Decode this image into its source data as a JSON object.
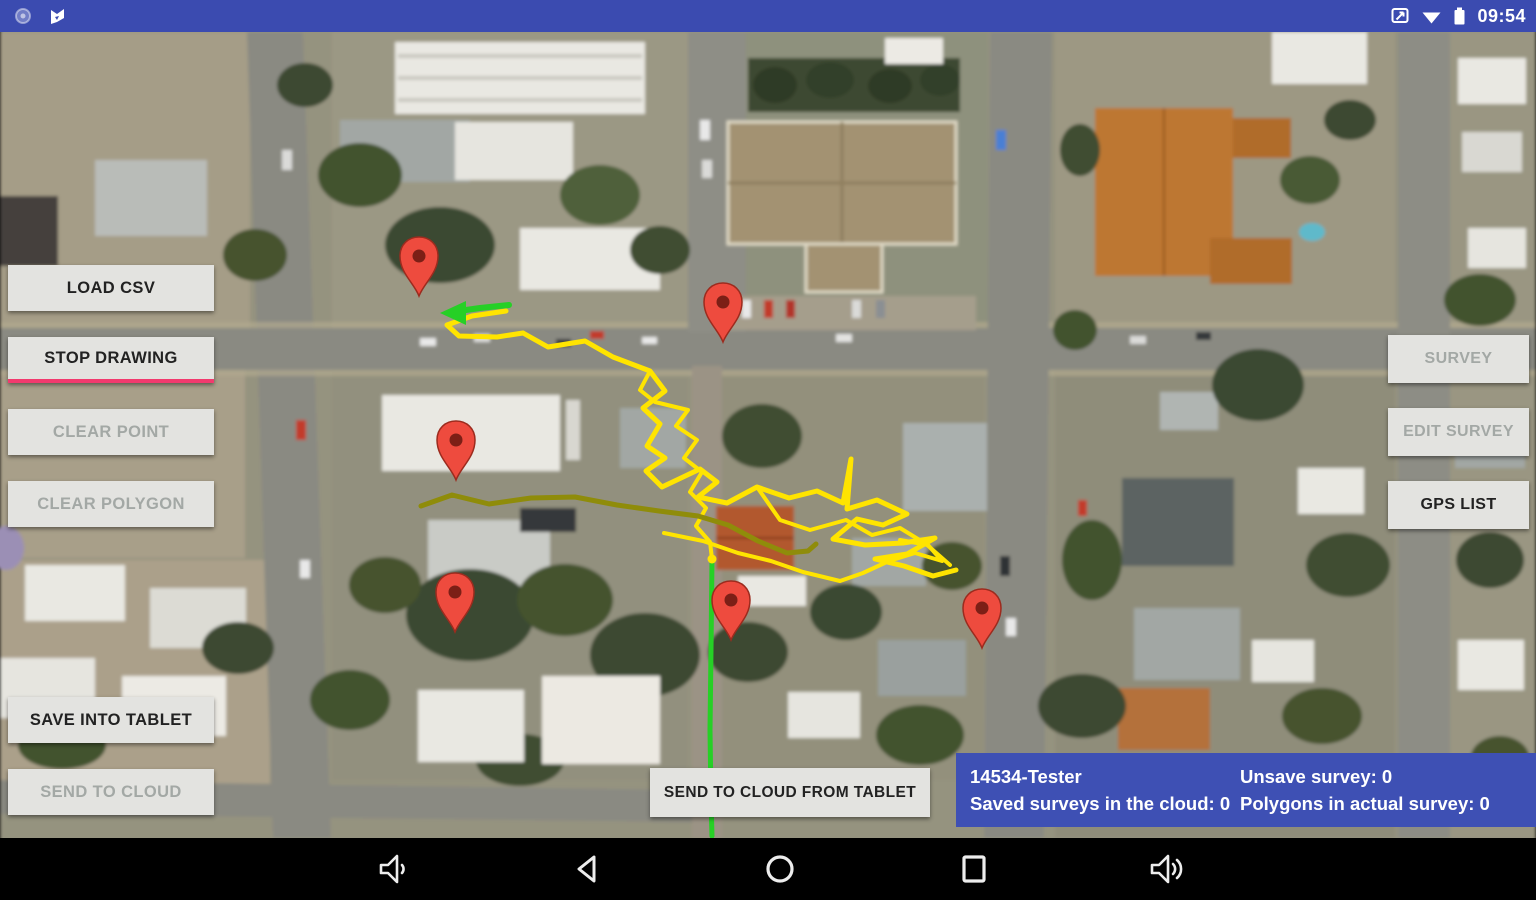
{
  "status_bar": {
    "time": "09:54",
    "left_icons": [
      "sync-status-icon",
      "flag-icon"
    ],
    "right_icons": [
      "screenshot-icon",
      "wifi-icon",
      "battery-icon"
    ]
  },
  "toolbar_left": {
    "buttons": [
      {
        "label": "LOAD CSV",
        "enabled": true,
        "accent": false
      },
      {
        "label": "STOP DRAWING",
        "enabled": true,
        "accent": true
      },
      {
        "label": "CLEAR POINT",
        "enabled": false,
        "accent": false
      },
      {
        "label": "CLEAR POLYGON",
        "enabled": false,
        "accent": false
      },
      {
        "label": "SAVE INTO TABLET",
        "enabled": true,
        "accent": false
      },
      {
        "label": "SEND TO CLOUD",
        "enabled": false,
        "accent": false
      }
    ]
  },
  "toolbar_right": {
    "buttons": [
      {
        "label": "SURVEY",
        "enabled": false,
        "accent": false
      },
      {
        "label": "EDIT SURVEY",
        "enabled": false,
        "accent": false
      },
      {
        "label": "GPS LIST",
        "enabled": true,
        "accent": false
      }
    ]
  },
  "bottom_button": {
    "label": "SEND TO CLOUD FROM TABLET",
    "enabled": true
  },
  "status_panel": {
    "bg_color": "#3e50b4",
    "left_line1": "14534-Tester",
    "left_line2": "Saved surveys in the cloud: 0",
    "right_line1": "Unsave survey: 0",
    "right_line2": "Polygons in actual survey: 0"
  },
  "nav_bar": {
    "icons": [
      "volume-down-icon",
      "back-icon",
      "home-icon",
      "recents-icon",
      "volume-up-icon"
    ]
  },
  "colors": {
    "accent_pink": "#f23a6e",
    "android_blue": "#3b4bb0",
    "pin_red": "#ee4b3e",
    "pin_dot": "#7c1f16",
    "track_yellow": "#ffe400",
    "track_olive": "#8f8c0a",
    "track_green": "#26d026"
  },
  "map": {
    "markers": [
      {
        "x": 419,
        "y": 296
      },
      {
        "x": 723,
        "y": 342
      },
      {
        "x": 456,
        "y": 480
      },
      {
        "x": 455,
        "y": 632
      },
      {
        "x": 731,
        "y": 640
      },
      {
        "x": 982,
        "y": 648
      }
    ],
    "tracks": [
      {
        "id": "gps-track-yellow-loop",
        "color": "#ffe400",
        "width": 5,
        "points": "506,311 472,316 447,325 459,336 497,337 523,333"
      },
      {
        "id": "gps-track-yellow-main",
        "color": "#ffe400",
        "width": 5,
        "points": "523,333 548,347 585,341 613,357 650,371 665,391 643,408 660,424 647,446 665,458 646,471 662,487 700,469 717,482 698,497 727,503 757,487 789,498 817,491 843,503 851,459 847,509 877,500 907,514 883,525 857,519 833,539 865,545 903,543 935,538 907,554 875,559 904,566 933,576 956,570"
      },
      {
        "id": "gps-track-yellow-cluster",
        "color": "#ffe400",
        "width": 4,
        "points": "757,487 780,520 810,530 846,520 872,535 900,528 926,544 950,565"
      },
      {
        "id": "gps-track-yellow-descent",
        "color": "#ffe400",
        "width": 4,
        "points": "650,371 640,390 655,402 688,410 676,426 697,440 684,458 702,472 690,492 706,508 696,526 710,542 712,559"
      },
      {
        "id": "gps-track-yellow-lower",
        "color": "#ffe400",
        "width": 4,
        "points": "664,533 703,541 738,553 771,561 803,572 840,581 863,573 889,561 915,553 942,561 928,545 900,540"
      },
      {
        "id": "gps-track-olive",
        "color": "#8f8c0a",
        "width": 5,
        "points": "421,506 452,495 489,504 531,498 575,497 617,505 659,511 698,516 728,525 758,541 787,553 808,551 816,544"
      },
      {
        "id": "gps-path-green-horizontal",
        "color": "#26d026",
        "width": 6,
        "points": "509,305 480,308 452,312",
        "arrow": "466,301 440,313 466,325"
      },
      {
        "id": "gps-path-green-vertical",
        "color": "#26d026",
        "width": 5,
        "points": "712,559 711,650 710,730 711,800 712,836"
      }
    ]
  }
}
